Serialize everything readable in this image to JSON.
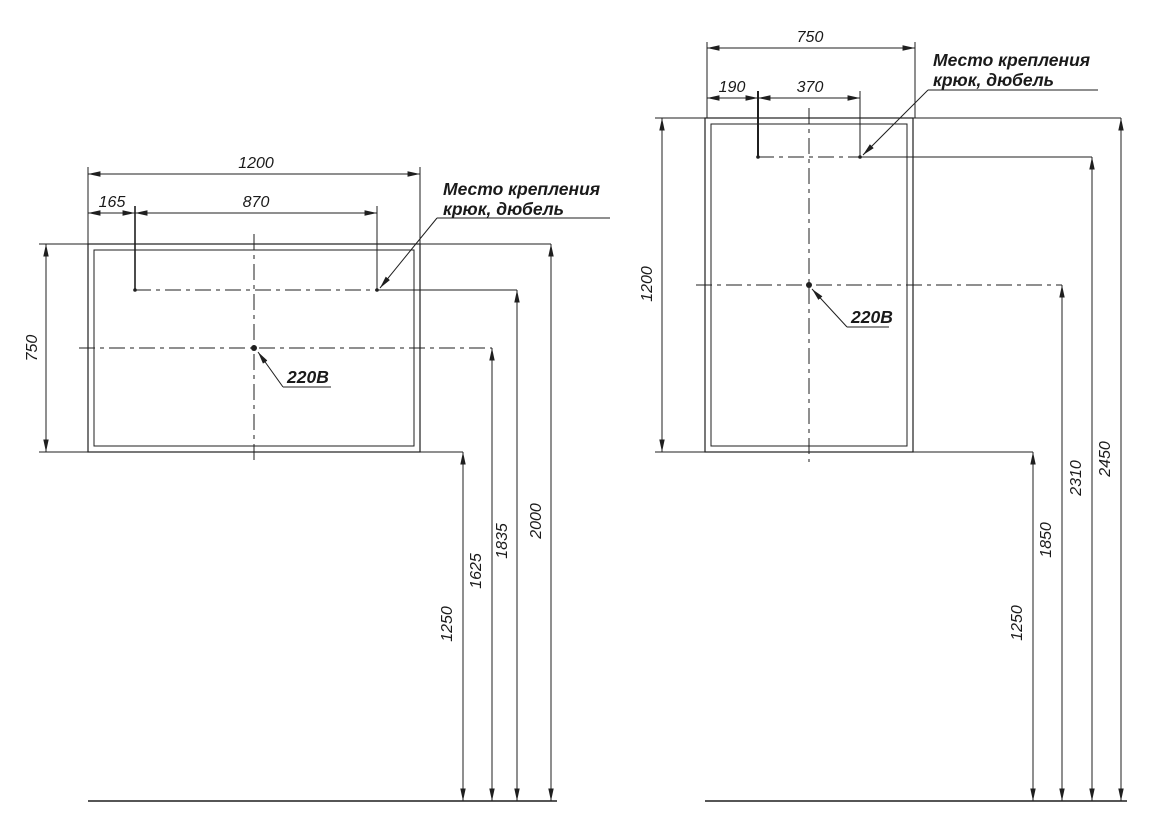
{
  "drawing_type": "mirror mounting dimensions, front views (landscape and portrait)",
  "colors": {
    "line": "#1f1f1f",
    "background": "#ffffff"
  },
  "left_drawing": {
    "width": "1200",
    "hook_offset": "165",
    "hook_span": "870",
    "height": "750",
    "floor_heights": {
      "bottom": "1250",
      "socket": "1625",
      "hook": "1835",
      "top": "2000"
    },
    "mount_note": {
      "line1": "Место крепления",
      "line2": "крюк, дюбель"
    },
    "power_note": "220В"
  },
  "right_drawing": {
    "width": "750",
    "hook_offset": "190",
    "hook_span": "370",
    "height": "1200",
    "floor_heights": {
      "bottom": "1250",
      "socket": "1850",
      "hook": "2310",
      "top": "2450"
    },
    "mount_note": {
      "line1": "Место крепления",
      "line2": "крюк, дюбель"
    },
    "power_note": "220В"
  }
}
